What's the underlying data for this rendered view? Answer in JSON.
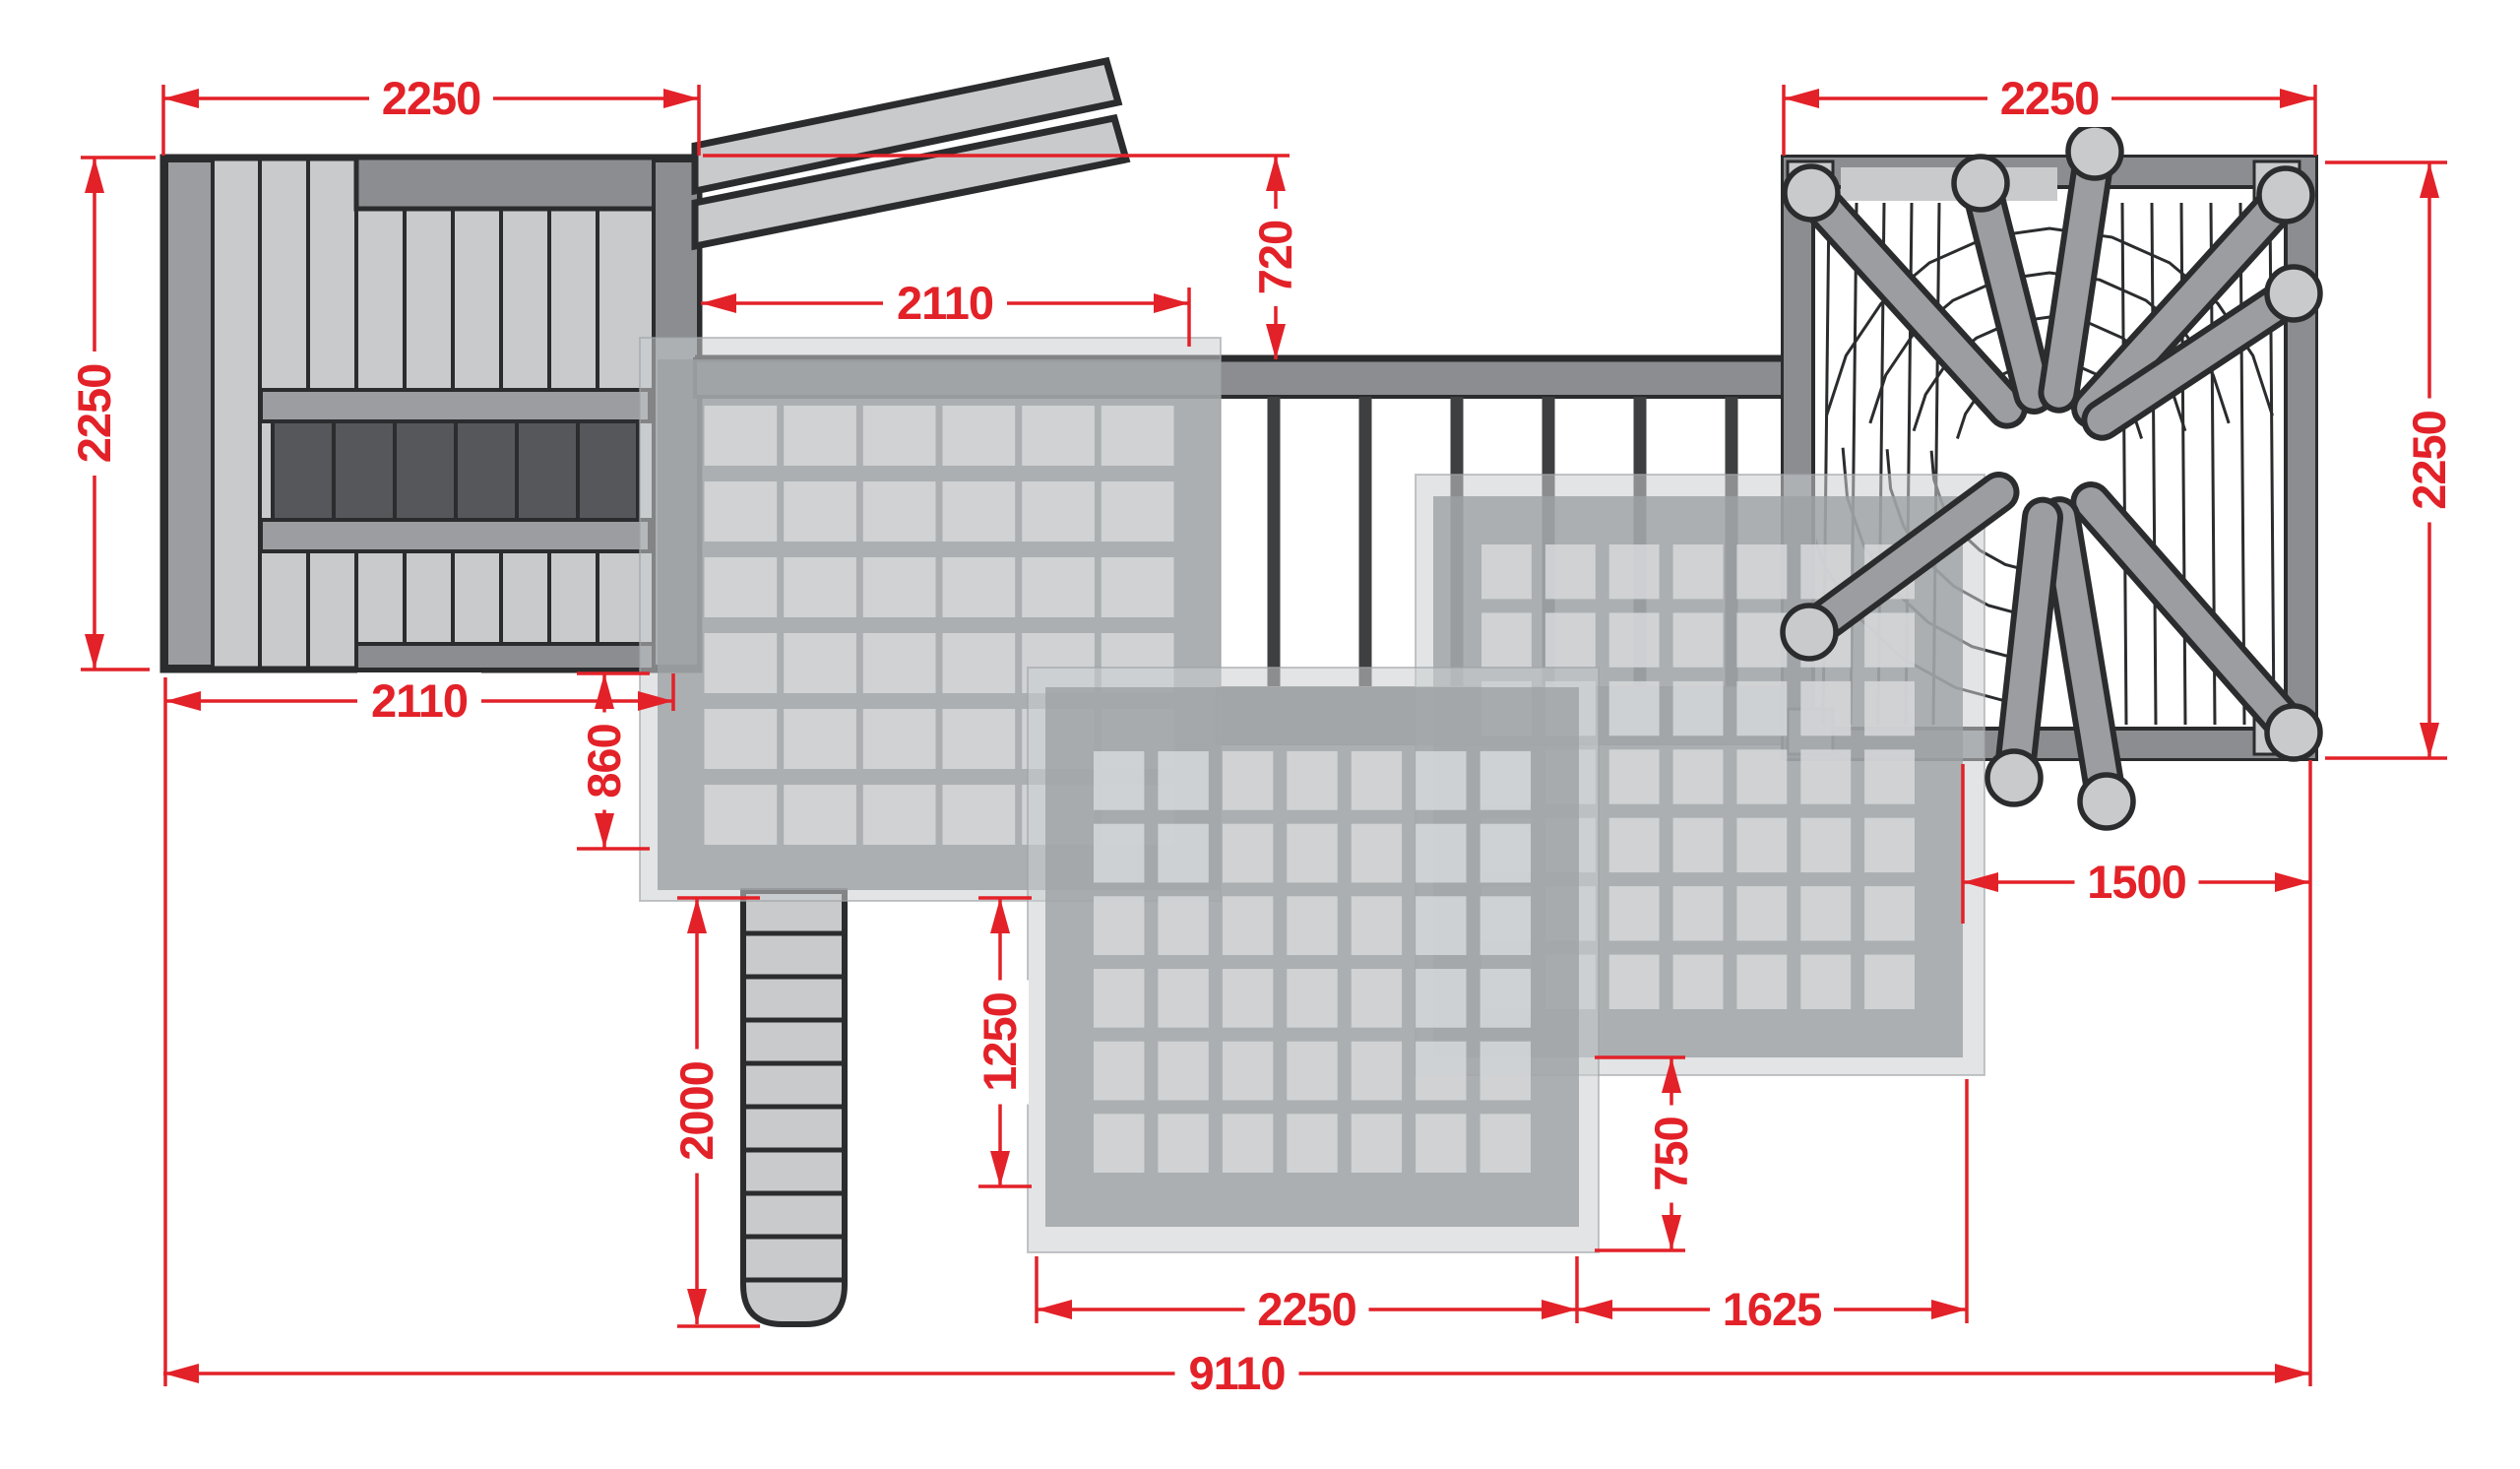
{
  "drawing": {
    "kind": "playground-structure-top-view-plan",
    "colors": {
      "dimension_red": "#e32128",
      "outline": "#2b2c2e",
      "plank_light": "#c8cacc",
      "plank_shaded": "#9b9da0",
      "wall_band": "#8b8d90",
      "hatch_dark": "#55575a",
      "railing_post": "#3e3f41",
      "web_spoke": "#9b9da0",
      "net_outer": "rgba(203,205,208,0.55)",
      "net_band": "rgba(158,161,164,0.8)",
      "net_cell": "rgba(214,216,218,0.85)",
      "walkway_deck": "#9fa1a4",
      "background": "#ffffff"
    },
    "dimensions": {
      "top_left_width": "2250",
      "top_right_width": "2250",
      "left_depth": "2250",
      "right_depth": "2250",
      "slide_length": "2110",
      "slide_offset": "720",
      "platform_bottom_width": "2110",
      "net_a_drop": "860",
      "ladder_length": "2000",
      "net_b_drop": "1250",
      "net_c_drop": "750",
      "net_b_width": "2250",
      "net_c_width": "1625",
      "web_tower_offset": "1500",
      "total_width": "9110"
    },
    "components": [
      "plank platform with hatch opening",
      "slide rails",
      "bridge walkway with railing posts",
      "spider-web climbing tower with radial spokes and post balls",
      "climbing net A",
      "climbing net B",
      "climbing net C",
      "access ladder"
    ]
  }
}
